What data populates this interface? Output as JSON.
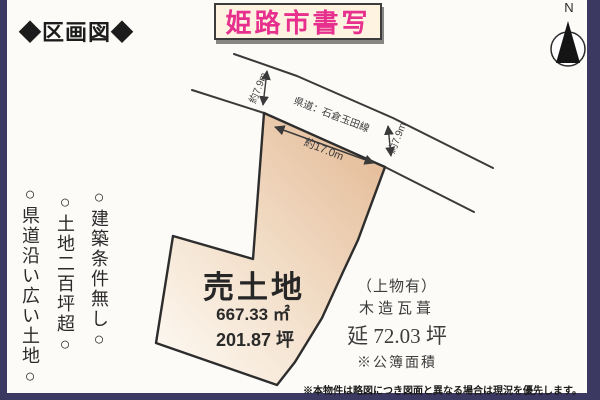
{
  "header": {
    "title": "◆区画図◆"
  },
  "badge": {
    "text": "姫路市書写"
  },
  "compass": {
    "label": "N"
  },
  "road": {
    "name": "県道：石倉玉田線"
  },
  "dimensions": {
    "frontage": "約17.0m",
    "left_width": "約7.9m",
    "right_width": "約7.9m"
  },
  "plot": {
    "title": "売土地",
    "area_sqm": "667.33 ㎡",
    "area_tsubo": "201.87 坪"
  },
  "building": {
    "note": "（上物有）",
    "structure": "木造瓦葺",
    "floor_area": "延 72.03 坪",
    "registry_note": "※公簿面積"
  },
  "features": [
    "○建築条件無し○",
    "○土地二百坪超○",
    "○県道沿い広い土地○"
  ],
  "footer": {
    "disclaimer": "※本物件は略図につき図面と異なる場合は現況を優先します。"
  },
  "colors": {
    "accent_pink": "#e7308d",
    "badge_bg": "#fdf3e0",
    "frame_navy": "#3b3962",
    "plot_fill_dark": "#e5bd9a",
    "plot_fill_light": "#fdf8f1",
    "line": "#3a3a3a"
  }
}
